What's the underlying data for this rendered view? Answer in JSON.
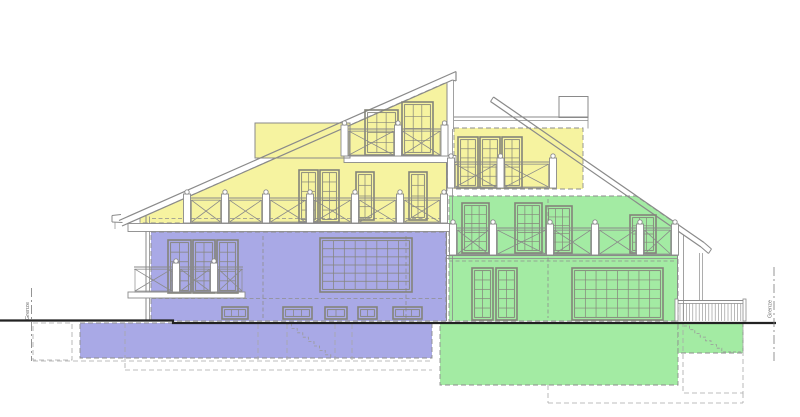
{
  "labels": {
    "boundary": "Grenze"
  },
  "colors": {
    "background": "#ffffff",
    "unit_attic": "#f6f3a0",
    "unit_left": "#a9a9e6",
    "unit_right": "#a3eba3",
    "line": "#8a8a8a",
    "frame": "#84847a",
    "zone_dash": "#8e8e8e",
    "underground_dash": "#a8a8a8",
    "ground": "#222222",
    "post_fill": "#ffffff"
  },
  "drawing": {
    "zones": [
      {
        "name": "attic-unit",
        "color_key": "unit_attic",
        "polys": [
          [
            [
              140,
              218
            ],
            [
              447,
              82
            ],
            [
              447,
              223
            ],
            [
              140,
              223
            ]
          ],
          [
            [
              255,
              123
            ],
            [
              350,
              123
            ],
            [
              350,
              158
            ],
            [
              255,
              158
            ]
          ],
          [
            [
              454,
              128
            ],
            [
              583,
              128
            ],
            [
              583,
              189
            ],
            [
              454,
              189
            ]
          ]
        ]
      },
      {
        "name": "left-unit",
        "color_key": "unit_left",
        "polys": [
          [
            [
              151,
              232
            ],
            [
              446,
              232
            ],
            [
              446,
              321
            ],
            [
              151,
              321
            ]
          ],
          [
            [
              80,
              323
            ],
            [
              432,
              323
            ],
            [
              432,
              358
            ],
            [
              80,
              358
            ]
          ]
        ]
      },
      {
        "name": "right-unit",
        "color_key": "unit_right",
        "polys": [
          [
            [
              449,
              196
            ],
            [
              636,
              196
            ],
            [
              678,
              225
            ],
            [
              678,
              321
            ],
            [
              449,
              321
            ]
          ],
          [
            [
              440,
              323
            ],
            [
              678,
              323
            ],
            [
              678,
              385
            ],
            [
              440,
              385
            ]
          ],
          [
            [
              678,
              323
            ],
            [
              743,
              323
            ],
            [
              743,
              353
            ],
            [
              678,
              353
            ]
          ]
        ]
      }
    ],
    "interior_dashed": [
      [
        152,
        218.5,
        444,
        218.5
      ],
      [
        152,
        298.5,
        443,
        298.5
      ],
      [
        263,
        236,
        263,
        318
      ],
      [
        406,
        236,
        406,
        318
      ],
      [
        449,
        261,
        675,
        261
      ],
      [
        548,
        199,
        548,
        318
      ]
    ],
    "lines": [
      [
        119,
        220.5,
        456,
        71.5,
        1.2
      ],
      [
        122,
        226,
        452.5,
        80,
        1.2
      ],
      [
        456,
        71.5,
        456,
        81,
        1.2
      ],
      [
        452.5,
        80,
        456,
        81,
        1
      ],
      [
        447,
        84,
        447,
        130,
        1
      ],
      [
        453.5,
        80,
        453.5,
        129,
        0.8
      ],
      [
        493.5,
        97,
        704,
        242.5,
        1.2
      ],
      [
        490.5,
        101.5,
        701,
        247,
        1.2
      ],
      [
        493.5,
        97,
        490.5,
        101.5,
        1
      ],
      [
        454,
        117,
        588,
        117,
        1
      ],
      [
        454,
        120.5,
        588,
        120.5,
        0.8
      ],
      [
        588,
        117,
        588,
        128.5,
        0.8
      ],
      [
        704,
        242.5,
        711.5,
        249,
        1
      ],
      [
        701,
        247,
        708.5,
        253.5,
        1
      ],
      [
        711.5,
        249,
        708.5,
        253.5,
        1
      ],
      [
        699.5,
        253,
        699.5,
        301,
        0.7
      ],
      [
        702.5,
        253,
        702.5,
        301,
        0.7
      ],
      [
        146,
        215,
        146,
        321,
        1
      ],
      [
        149.5,
        216.5,
        149.5,
        321,
        0.8
      ],
      [
        446.5,
        129,
        446.5,
        321,
        1
      ],
      [
        452.5,
        129,
        452.5,
        321,
        0.8
      ],
      [
        677.5,
        231,
        677.5,
        321,
        1
      ],
      [
        683.5,
        235,
        683.5,
        321,
        0.8
      ],
      [
        446.5,
        255.5,
        677,
        255.5,
        1
      ],
      [
        446.5,
        258.5,
        677,
        258.5,
        0.7
      ],
      [
        112,
        215.5,
        121,
        214.5,
        1
      ],
      [
        112,
        215.5,
        112,
        222,
        1
      ],
      [
        112,
        222,
        122.5,
        222.5,
        1
      ],
      [
        115,
        222,
        115,
        229,
        0.7
      ]
    ],
    "slabs": [
      [
        128,
        223.5,
        325,
        8
      ],
      [
        344,
        155.5,
        112,
        7
      ],
      [
        128,
        292,
        117,
        6
      ]
    ],
    "boxes": [
      [
        255,
        123,
        95,
        35
      ],
      [
        559,
        96.5,
        29,
        21
      ]
    ],
    "windows": [
      [
        365,
        110,
        33,
        45,
        3,
        4
      ],
      [
        402,
        102,
        31,
        53,
        3,
        4
      ],
      [
        299,
        170,
        19,
        52,
        2,
        5
      ],
      [
        320,
        170,
        19,
        52,
        2,
        5
      ],
      [
        356,
        172,
        18,
        48,
        2,
        4
      ],
      [
        409,
        172,
        18,
        48,
        2,
        4
      ],
      [
        458,
        137,
        20,
        51,
        2,
        5
      ],
      [
        480,
        137,
        20,
        51,
        2,
        5
      ],
      [
        502,
        137,
        20,
        51,
        2,
        5
      ],
      [
        168,
        240,
        23,
        53,
        2,
        5
      ],
      [
        193,
        240,
        22,
        53,
        2,
        5
      ],
      [
        217,
        240,
        21,
        53,
        2,
        5
      ],
      [
        320,
        238,
        92,
        54,
        8,
        6
      ],
      [
        222,
        307,
        26,
        12,
        3,
        1
      ],
      [
        283,
        307,
        29,
        12,
        3,
        1
      ],
      [
        325,
        307,
        22,
        12,
        2,
        1
      ],
      [
        358,
        307,
        19,
        12,
        2,
        1
      ],
      [
        393,
        307,
        29,
        12,
        3,
        1
      ],
      [
        462,
        203,
        27,
        50,
        3,
        5
      ],
      [
        515,
        203,
        27,
        50,
        3,
        5
      ],
      [
        546,
        206,
        26,
        47,
        3,
        5
      ],
      [
        630,
        215,
        26,
        38,
        3,
        4
      ],
      [
        472,
        268,
        21,
        52,
        2,
        5
      ],
      [
        496,
        268,
        21,
        52,
        2,
        5
      ],
      [
        572,
        268,
        91,
        52,
        8,
        5
      ]
    ],
    "railings_x": [
      {
        "x1": 341,
        "x2": 448,
        "top": 129,
        "bot": 156,
        "posts": [
          344.5,
          398,
          444.5
        ]
      },
      {
        "x1": 184,
        "x2": 447,
        "top": 198,
        "bot": 223,
        "posts": [
          187,
          225,
          266,
          310,
          355,
          400,
          444
        ]
      },
      {
        "x1": 448,
        "x2": 556,
        "top": 162,
        "bot": 188,
        "posts": [
          451,
          500.5,
          553
        ]
      },
      {
        "x1": 450,
        "x2": 678,
        "top": 228,
        "bot": 255,
        "posts": [
          453,
          493,
          550,
          595,
          640,
          675
        ]
      },
      {
        "x1": 134,
        "x2": 243,
        "top": 267,
        "bot": 292,
        "posts": [
          176,
          214
        ]
      }
    ],
    "slat_railing": {
      "x1": 676.5,
      "x2": 744.5,
      "top": 300.5,
      "bot": 321,
      "gap": 3.2
    },
    "stairs": [
      {
        "x": 286,
        "y": 324,
        "n": 8,
        "dx": 5.6,
        "dy": 4.4,
        "tail": 0
      },
      {
        "x": 684,
        "y": 326,
        "n": 7,
        "dx": 5.4,
        "dy": 3.7,
        "tail": 20
      }
    ],
    "underground_dashed": [
      [
        33,
        361,
        432,
        361
      ],
      [
        125,
        370,
        432,
        370
      ],
      [
        125,
        323,
        125,
        370
      ],
      [
        258,
        324,
        258,
        360
      ],
      [
        287,
        324,
        287,
        360
      ],
      [
        335,
        324,
        335,
        360
      ],
      [
        352,
        324,
        352,
        360
      ],
      [
        548,
        385,
        548,
        403
      ],
      [
        548,
        403,
        743,
        403
      ],
      [
        743,
        393,
        743,
        403
      ]
    ],
    "underground_rects": [
      [
        33,
        323,
        39,
        37
      ],
      [
        683,
        323,
        60,
        70
      ]
    ],
    "ground": [
      [
        0,
        320.5
      ],
      [
        173,
        320.5
      ],
      [
        173,
        323
      ],
      [
        776,
        323
      ]
    ],
    "boundaries": [
      {
        "side": "left",
        "x": 31.5,
        "y1": 288,
        "y2": 361,
        "lx": 29,
        "ly": 311
      },
      {
        "side": "right",
        "x": 774,
        "y1": 267,
        "y2": 361,
        "lx": 771.5,
        "ly": 309
      }
    ]
  }
}
